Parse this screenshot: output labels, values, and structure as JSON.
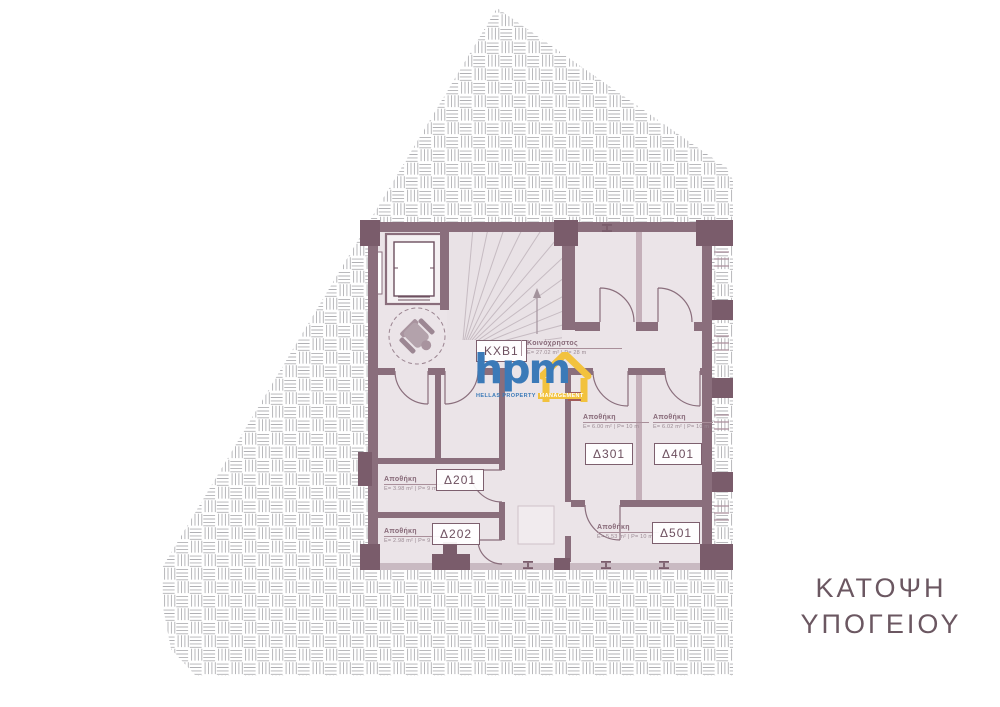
{
  "title": {
    "line1": "ΚΑΤΟΨΗ",
    "line2": "ΥΠΟΓΕΙΟΥ"
  },
  "logo": {
    "text": "hpm",
    "tagline_primary": "HELLAS PROPERTY",
    "tagline_accent": "MANAGEMENT",
    "blue": "#3b7ab8",
    "yellow": "#f2c23e"
  },
  "common_area": {
    "code": "KXB1",
    "name": "Κοινόχρηστος",
    "metrics": "Ε= 27.02 m² | P= 28 m"
  },
  "rooms": [
    {
      "code": "Δ201",
      "name": "Αποθήκη",
      "metrics": "Ε= 3.98 m² | P= 9 m"
    },
    {
      "code": "Δ202",
      "name": "Αποθήκη",
      "metrics": "Ε= 2.98 m² | P= 9 m"
    },
    {
      "code": "Δ301",
      "name": "Αποθήκη",
      "metrics": "Ε= 6.00 m² | P= 10 m"
    },
    {
      "code": "Δ401",
      "name": "Αποθήκη",
      "metrics": "Ε= 6.02 m² | P= 10 m"
    },
    {
      "code": "Δ501",
      "name": "Αποθήκη",
      "metrics": "Ε= 5.53 m² | P= 10 m"
    }
  ],
  "colors": {
    "wall": "#8a6e7c",
    "column": "#7a5c6b",
    "light_wall": "#c4afb9",
    "floor": "#ebe4e8",
    "hatch_line": "#b0b0b4",
    "title_text": "#6b5761"
  }
}
